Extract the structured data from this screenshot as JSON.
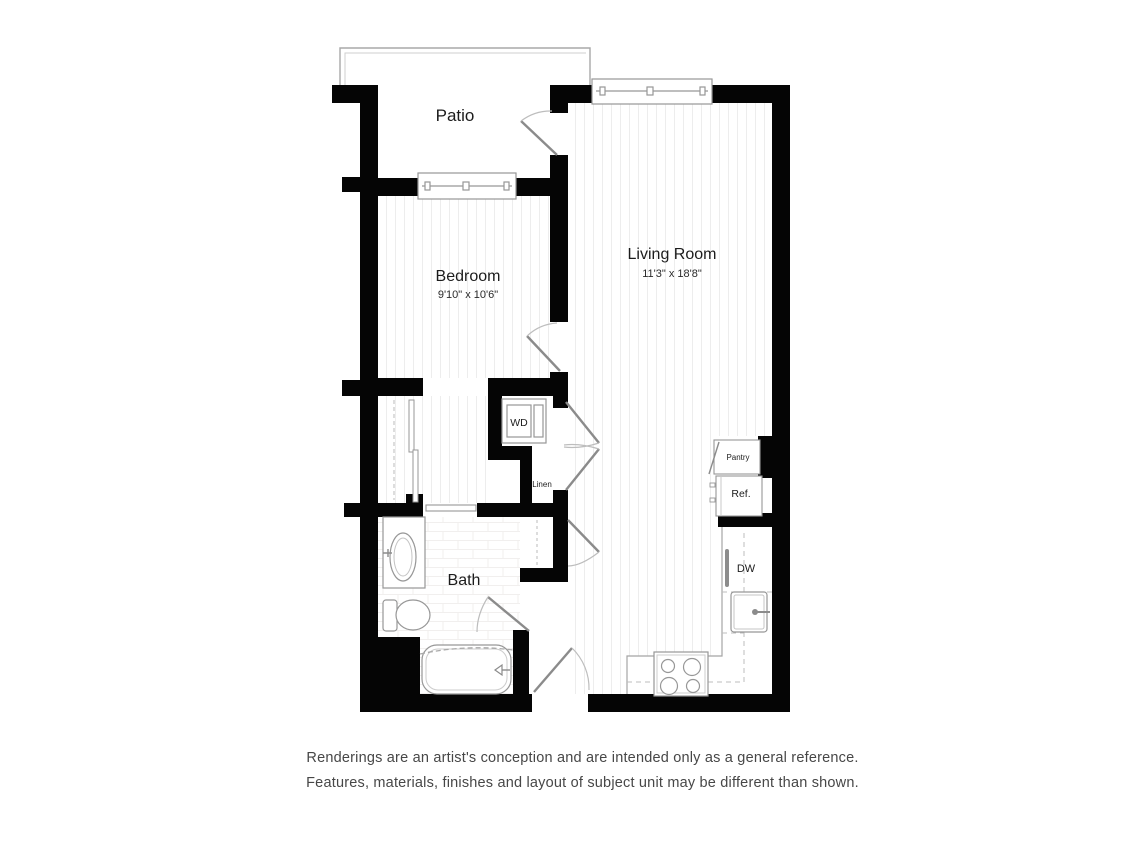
{
  "floor_plan": {
    "rooms": {
      "patio": {
        "label": "Patio"
      },
      "bedroom": {
        "label": "Bedroom",
        "dimensions": "9'10\" x 10'6\""
      },
      "living_room": {
        "label": "Living Room",
        "dimensions": "11'3\" x 18'8\""
      },
      "bath": {
        "label": "Bath"
      }
    },
    "fixtures": {
      "washer_dryer": "WD",
      "linen": "Linen",
      "pantry": "Pantry",
      "refrigerator": "Ref.",
      "dishwasher": "DW"
    },
    "colors": {
      "wall": "#050505",
      "fixture_line": "#999999",
      "floor_stripe": "#ededed"
    }
  },
  "disclaimer": {
    "line1": "Renderings are an artist's conception and are intended only as a general reference.",
    "line2": "Features, materials, finishes and layout of subject unit may be different than shown."
  }
}
